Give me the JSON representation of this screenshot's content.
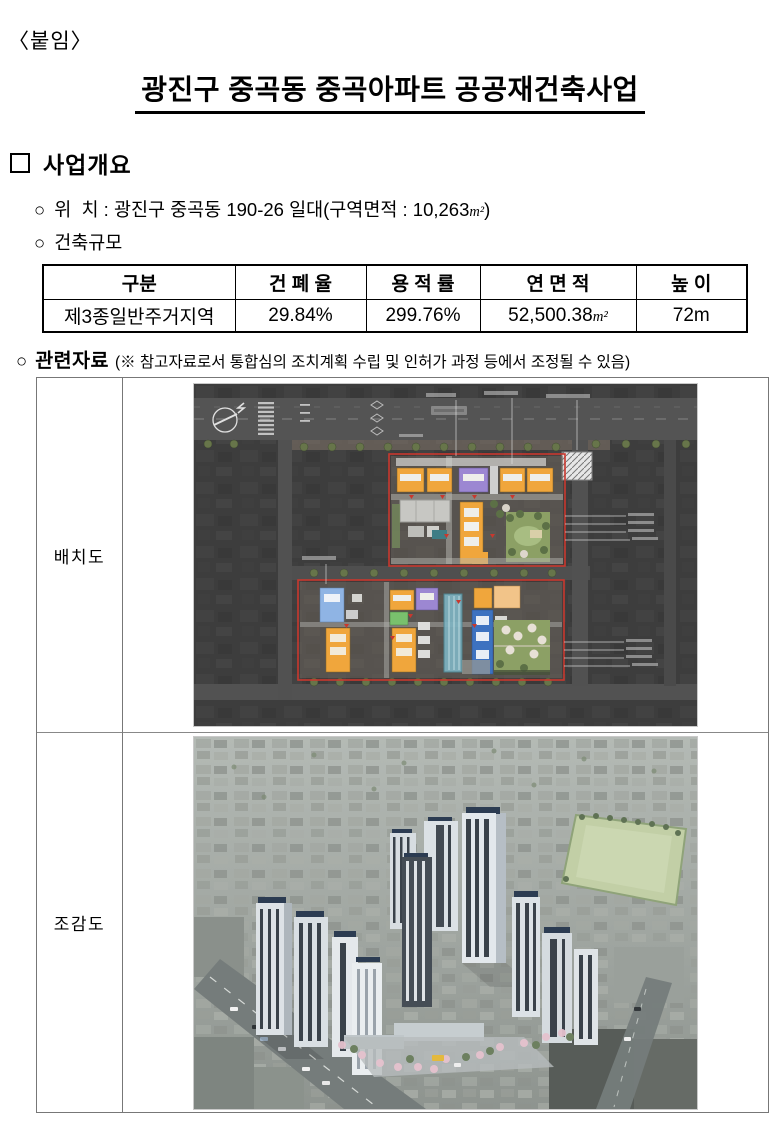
{
  "page": {
    "attachment_label": "〈붙임〉",
    "title": "광진구 중곡동 중곡아파트 공공재건축사업"
  },
  "bullets": {
    "square": "",
    "circle": "○"
  },
  "units": {
    "area": "m²"
  },
  "overview": {
    "heading": "사업개요",
    "location_label": "위  치 : ",
    "location_value_prefix": "광진구 중곡동 190-26 일대(구역면적 : 10,263",
    "location_value_suffix": ")",
    "scale_heading": "건축규모"
  },
  "building_table": {
    "headers": [
      "구분",
      "건 폐 율",
      "용 적 률",
      "연 면 적",
      "높  이"
    ],
    "row": {
      "zone": "제3종일반주거지역",
      "coverage_ratio": "29.84%",
      "floor_area_ratio": "299.76%",
      "gross_floor_area": "52,500.38",
      "height": "72m"
    }
  },
  "related": {
    "heading": "관련자료",
    "note": "(※ 참고자료로서 통합심의 조치계획 수립 및 인허가 과정 등에서 조정될 수 있음)"
  },
  "figures": [
    {
      "label": "배치도",
      "image": "site-plan-aerial-illustration"
    },
    {
      "label": "조감도",
      "image": "birdseye-rendering-illustration"
    }
  ],
  "colors": {
    "site_bg": "#3d3d3d",
    "site_road": "#545454",
    "boundary_red": "#c8382e",
    "bldg_orange": "#f0a63c",
    "bldg_peach": "#f2c489",
    "bldg_purple": "#9c87d2",
    "bldg_blue": "#3d72c0",
    "bldg_lightblue": "#8fb4e4",
    "bldg_green": "#79c06d",
    "park_green": "#8ca065",
    "tree_olive": "#67754a",
    "pool_teal": "#7fb5c4",
    "field_green": "#c2cfa6",
    "tower_light": "#e3e8ec",
    "tower_dark": "#3a424a",
    "solar_navy": "#2c3c52",
    "blossom_pink": "#e5c2ce",
    "road_gray": "#757c7b"
  }
}
